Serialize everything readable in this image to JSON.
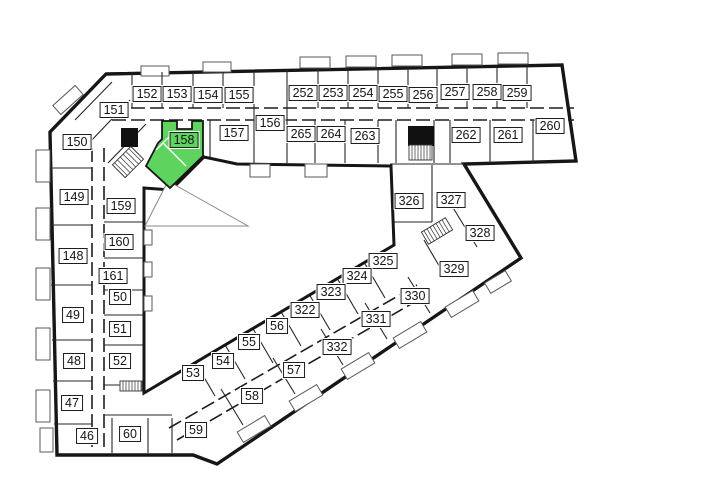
{
  "plan": {
    "selected_unit": "158"
  },
  "colors": {
    "highlight": "#5ed35e",
    "wall": "#161616"
  },
  "units": {
    "u46": "46",
    "u47": "47",
    "u48": "48",
    "u49": "49",
    "u50": "50",
    "u51": "51",
    "u52": "52",
    "u53": "53",
    "u54": "54",
    "u55": "55",
    "u56": "56",
    "u57": "57",
    "u58": "58",
    "u59": "59",
    "u60": "60",
    "u148": "148",
    "u149": "149",
    "u150": "150",
    "u151": "151",
    "u152": "152",
    "u153": "153",
    "u154": "154",
    "u155": "155",
    "u156": "156",
    "u157": "157",
    "u158": "158",
    "u159": "159",
    "u160": "160",
    "u161": "161",
    "u252": "252",
    "u253": "253",
    "u254": "254",
    "u255": "255",
    "u256": "256",
    "u257": "257",
    "u258": "258",
    "u259": "259",
    "u260": "260",
    "u261": "261",
    "u262": "262",
    "u263": "263",
    "u264": "264",
    "u265": "265",
    "u322": "322",
    "u323": "323",
    "u324": "324",
    "u325": "325",
    "u326": "326",
    "u327": "327",
    "u328": "328",
    "u329": "329",
    "u330": "330",
    "u331": "331",
    "u332": "332"
  }
}
